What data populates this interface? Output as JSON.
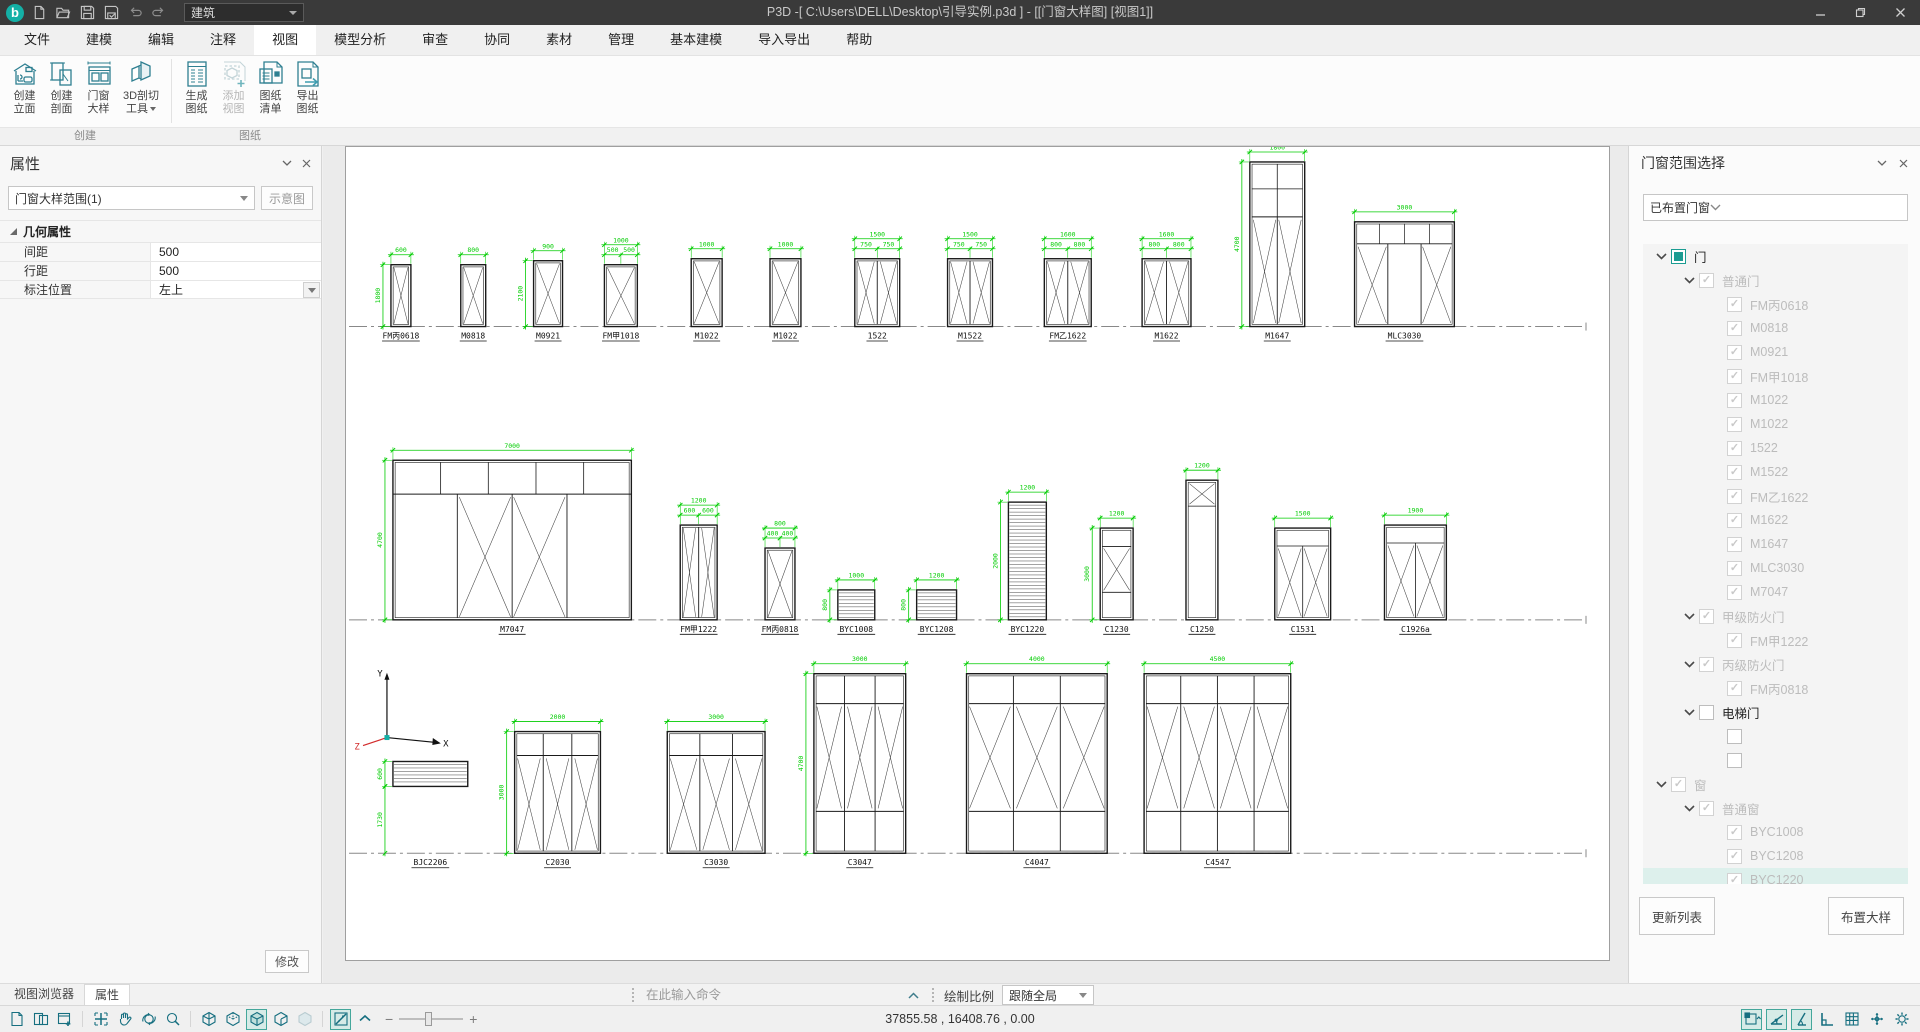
{
  "window": {
    "title": "P3D -[ C:\\Users\\DELL\\Desktop\\引导实例.p3d ] - [[门窗大样图] [视图1]]",
    "profile": "建筑"
  },
  "menubar": {
    "items": [
      "文件",
      "建模",
      "编辑",
      "注释",
      "视图",
      "模型分析",
      "审查",
      "协同",
      "素材",
      "管理",
      "基本建模",
      "导入导出",
      "帮助"
    ],
    "active": "视图"
  },
  "ribbon": {
    "groups": [
      {
        "label": "创建",
        "buttons": [
          {
            "label1": "创建",
            "label2": "立面",
            "icon": "elevation-icon"
          },
          {
            "label1": "创建",
            "label2": "剖面",
            "icon": "section-icon"
          },
          {
            "label1": "门窗",
            "label2": "大样",
            "icon": "door-window-detail-icon"
          },
          {
            "label1": "3D剖切",
            "label2": "工具",
            "icon": "cut-3d-icon",
            "dropdown": true
          }
        ]
      },
      {
        "label": "图纸",
        "buttons": [
          {
            "label1": "生成",
            "label2": "图纸",
            "icon": "generate-sheet-icon"
          },
          {
            "label1": "添加",
            "label2": "视图",
            "icon": "add-view-icon",
            "disabled": true
          },
          {
            "label1": "图纸",
            "label2": "清单",
            "icon": "sheet-list-icon"
          },
          {
            "label1": "导出",
            "label2": "图纸",
            "icon": "export-sheet-icon"
          }
        ]
      }
    ]
  },
  "properties_panel": {
    "title": "属性",
    "selector": "门窗大样范围(1)",
    "schematic_button": "示意图",
    "section": "几何属性",
    "rows": [
      {
        "label": "间距",
        "value": "500"
      },
      {
        "label": "行距",
        "value": "500"
      },
      {
        "label": "标注位置",
        "value": "左上",
        "dropdown": true
      }
    ],
    "modify_button": "修改",
    "tabs": [
      {
        "label": "视图浏览器",
        "active": false
      },
      {
        "label": "属性",
        "active": true
      }
    ]
  },
  "range_panel": {
    "title": "门窗范围选择",
    "filter": "已布置门窗",
    "update_button": "更新列表",
    "place_button": "布置大样",
    "tree": [
      {
        "label": "门",
        "level": 0,
        "state": "indeterminate",
        "expand": true
      },
      {
        "label": "普通门",
        "level": 1,
        "state": "checked",
        "expand": true,
        "dim": true
      },
      {
        "label": "FM丙0618",
        "level": 2,
        "state": "checked",
        "dim": true
      },
      {
        "label": "M0818",
        "level": 2,
        "state": "checked",
        "dim": true
      },
      {
        "label": "M0921",
        "level": 2,
        "state": "checked",
        "dim": true
      },
      {
        "label": "FM甲1018",
        "level": 2,
        "state": "checked",
        "dim": true
      },
      {
        "label": "M1022",
        "level": 2,
        "state": "checked",
        "dim": true
      },
      {
        "label": "M1022",
        "level": 2,
        "state": "checked",
        "dim": true
      },
      {
        "label": "1522",
        "level": 2,
        "state": "checked",
        "dim": true
      },
      {
        "label": "M1522",
        "level": 2,
        "state": "checked",
        "dim": true
      },
      {
        "label": "FM乙1622",
        "level": 2,
        "state": "checked",
        "dim": true
      },
      {
        "label": "M1622",
        "level": 2,
        "state": "checked",
        "dim": true
      },
      {
        "label": "M1647",
        "level": 2,
        "state": "checked",
        "dim": true
      },
      {
        "label": "MLC3030",
        "level": 2,
        "state": "checked",
        "dim": true
      },
      {
        "label": "M7047",
        "level": 2,
        "state": "checked",
        "dim": true
      },
      {
        "label": "甲级防火门",
        "level": 1,
        "state": "checked",
        "expand": true,
        "dim": true
      },
      {
        "label": "FM甲1222",
        "level": 2,
        "state": "checked",
        "dim": true
      },
      {
        "label": "丙级防火门",
        "level": 1,
        "state": "checked",
        "expand": true,
        "dim": true
      },
      {
        "label": "FM丙0818",
        "level": 2,
        "state": "checked",
        "dim": true
      },
      {
        "label": "电梯门",
        "level": 1,
        "state": "unchecked",
        "expand": true
      },
      {
        "label": "",
        "level": 2,
        "state": "unchecked"
      },
      {
        "label": "",
        "level": 2,
        "state": "unchecked"
      },
      {
        "label": "窗",
        "level": 0,
        "state": "checked",
        "expand": true,
        "dim": true
      },
      {
        "label": "普通窗",
        "level": 1,
        "state": "checked",
        "expand": true,
        "dim": true
      },
      {
        "label": "BYC1008",
        "level": 2,
        "state": "checked",
        "dim": true
      },
      {
        "label": "BYC1208",
        "level": 2,
        "state": "checked",
        "dim": true
      },
      {
        "label": "BYC1220",
        "level": 2,
        "state": "checked",
        "dim": true,
        "highlight": true
      }
    ]
  },
  "command_bar": {
    "placeholder": "在此输入命令",
    "scale_label": "绘制比例",
    "scale_value": "跟随全局"
  },
  "status_bar": {
    "coordinates": "37855.58 , 16408.76 , 0.00",
    "left_tools": [
      {
        "name": "new-drawing-icon"
      },
      {
        "name": "tile-views-icon"
      },
      {
        "name": "new-view-window-icon"
      },
      {
        "sep": true
      },
      {
        "name": "zoom-extents-icon"
      },
      {
        "name": "pan-icon"
      },
      {
        "name": "orbit-icon"
      },
      {
        "name": "zoom-window-icon"
      },
      {
        "sep": true
      },
      {
        "name": "view-wireframe-icon"
      },
      {
        "name": "view-hidden-line-icon"
      },
      {
        "name": "view-shaded-icon",
        "active": true
      },
      {
        "name": "view-conceptual-icon"
      },
      {
        "name": "view-realistic-icon",
        "disabled": true
      },
      {
        "sep": true
      },
      {
        "name": "annotation-display-icon",
        "active": true
      },
      {
        "name": "collapse-toolbar-icon"
      }
    ],
    "right_tools": [
      {
        "name": "selection-cycling-icon",
        "active": true
      },
      {
        "name": "polar-tracking-icon",
        "active": true
      },
      {
        "name": "object-snap-icon",
        "active": true
      },
      {
        "name": "ortho-mode-icon"
      },
      {
        "name": "grid-display-icon"
      },
      {
        "name": "gizmo-icon"
      },
      {
        "name": "settings-gear-icon"
      }
    ]
  },
  "canvas": {
    "dim_color": "#00cc00",
    "axis": {
      "y": "Y",
      "x": "X",
      "z": "Z"
    },
    "rows": [
      {
        "y": 180,
        "units": [
          {
            "label": "FM丙0618",
            "x": 44,
            "w": 20,
            "h": 62,
            "top": "600",
            "left": "1800",
            "type": "door"
          },
          {
            "label": "M0818",
            "x": 114,
            "w": 25,
            "h": 62,
            "top": "800",
            "type": "door"
          },
          {
            "label": "M0921",
            "x": 187,
            "w": 29,
            "h": 66,
            "top": "900",
            "left": "2100",
            "type": "door"
          },
          {
            "label": "FM甲1018",
            "x": 258,
            "w": 33,
            "h": 62,
            "top": "1000",
            "subs": [
              "500",
              "500"
            ],
            "type": "door"
          },
          {
            "label": "M1022",
            "x": 345,
            "w": 31,
            "h": 68,
            "top": "1000",
            "type": "door"
          },
          {
            "label": "M1022",
            "x": 424,
            "w": 31,
            "h": 68,
            "top": "1000",
            "type": "door"
          },
          {
            "label": "1522",
            "x": 509,
            "w": 45,
            "h": 68,
            "top": "1500",
            "subs": [
              "750",
              "750"
            ],
            "type": "door",
            "cols": 2
          },
          {
            "label": "M1522",
            "x": 602,
            "w": 45,
            "h": 68,
            "top": "1500",
            "subs": [
              "750",
              "750"
            ],
            "type": "door",
            "cols": 2
          },
          {
            "label": "FM乙1622",
            "x": 699,
            "w": 47,
            "h": 68,
            "top": "1600",
            "subs": [
              "800",
              "800"
            ],
            "type": "door",
            "cols": 2
          },
          {
            "label": "M1622",
            "x": 797,
            "w": 49,
            "h": 68,
            "top": "1600",
            "subs": [
              "800",
              "800"
            ],
            "type": "door",
            "cols": 2
          },
          {
            "label": "M1647",
            "x": 905,
            "w": 55,
            "h": 165,
            "top": "1800",
            "left": "4700",
            "type": "tall-door"
          },
          {
            "label": "MLC3030",
            "x": 1010,
            "w": 100,
            "h": 105,
            "top": "3000",
            "type": "grid-door"
          }
        ]
      },
      {
        "y": 474,
        "units": [
          {
            "label": "M7047",
            "x": 46,
            "w": 239,
            "h": 160,
            "top": "7000",
            "left": "4700",
            "type": "storefront"
          },
          {
            "label": "FM甲1222",
            "x": 334,
            "w": 37,
            "h": 95,
            "top": "1200",
            "subs": [
              "600",
              "600"
            ],
            "type": "door",
            "cols": 2
          },
          {
            "label": "FM丙0818",
            "x": 419,
            "w": 30,
            "h": 72,
            "top": "800",
            "subs": [
              "400",
              "400"
            ],
            "type": "door"
          },
          {
            "label": "BYC1008",
            "x": 492,
            "w": 37,
            "h": 30,
            "top": "1000",
            "left": "800",
            "type": "louver"
          },
          {
            "label": "BYC1208",
            "x": 571,
            "w": 40,
            "h": 30,
            "top": "1200",
            "left": "800",
            "type": "louver"
          },
          {
            "label": "BYC1220",
            "x": 663,
            "w": 38,
            "h": 118,
            "top": "1200",
            "left": "2000",
            "type": "louver"
          },
          {
            "label": "C1230",
            "x": 755,
            "w": 33,
            "h": 92,
            "top": "1200",
            "left": "3000",
            "type": "window"
          },
          {
            "label": "C1250",
            "x": 841,
            "w": 32,
            "h": 140,
            "top": "1200",
            "type": "window-tall"
          },
          {
            "label": "C1531",
            "x": 930,
            "w": 56,
            "h": 92,
            "top": "1500",
            "type": "window2"
          },
          {
            "label": "C1926a",
            "x": 1040,
            "w": 62,
            "h": 95,
            "top": "1900",
            "type": "window2"
          }
        ]
      },
      {
        "y": 708,
        "units": [
          {
            "label": "BJC2206",
            "x": 46,
            "w": 75,
            "h": 25,
            "lift": 67,
            "left": "600",
            "lift_dim": "1730",
            "type": "louver"
          },
          {
            "label": "C2030",
            "x": 168,
            "w": 86,
            "h": 122,
            "top": "2000",
            "left": "3000",
            "type": "window-grid",
            "cols": 3
          },
          {
            "label": "C3030",
            "x": 321,
            "w": 98,
            "h": 122,
            "top": "3000",
            "type": "window-grid",
            "cols": 3
          },
          {
            "label": "C3047",
            "x": 468,
            "w": 92,
            "h": 180,
            "top": "3000",
            "left": "4700",
            "type": "window-grid3",
            "cols": 3
          },
          {
            "label": "C4047",
            "x": 621,
            "w": 141,
            "h": 180,
            "top": "4000",
            "type": "window-grid3",
            "cols": 3
          },
          {
            "label": "C4547",
            "x": 799,
            "w": 147,
            "h": 180,
            "top": "4500",
            "type": "window-grid3",
            "cols": 4
          }
        ]
      }
    ]
  }
}
